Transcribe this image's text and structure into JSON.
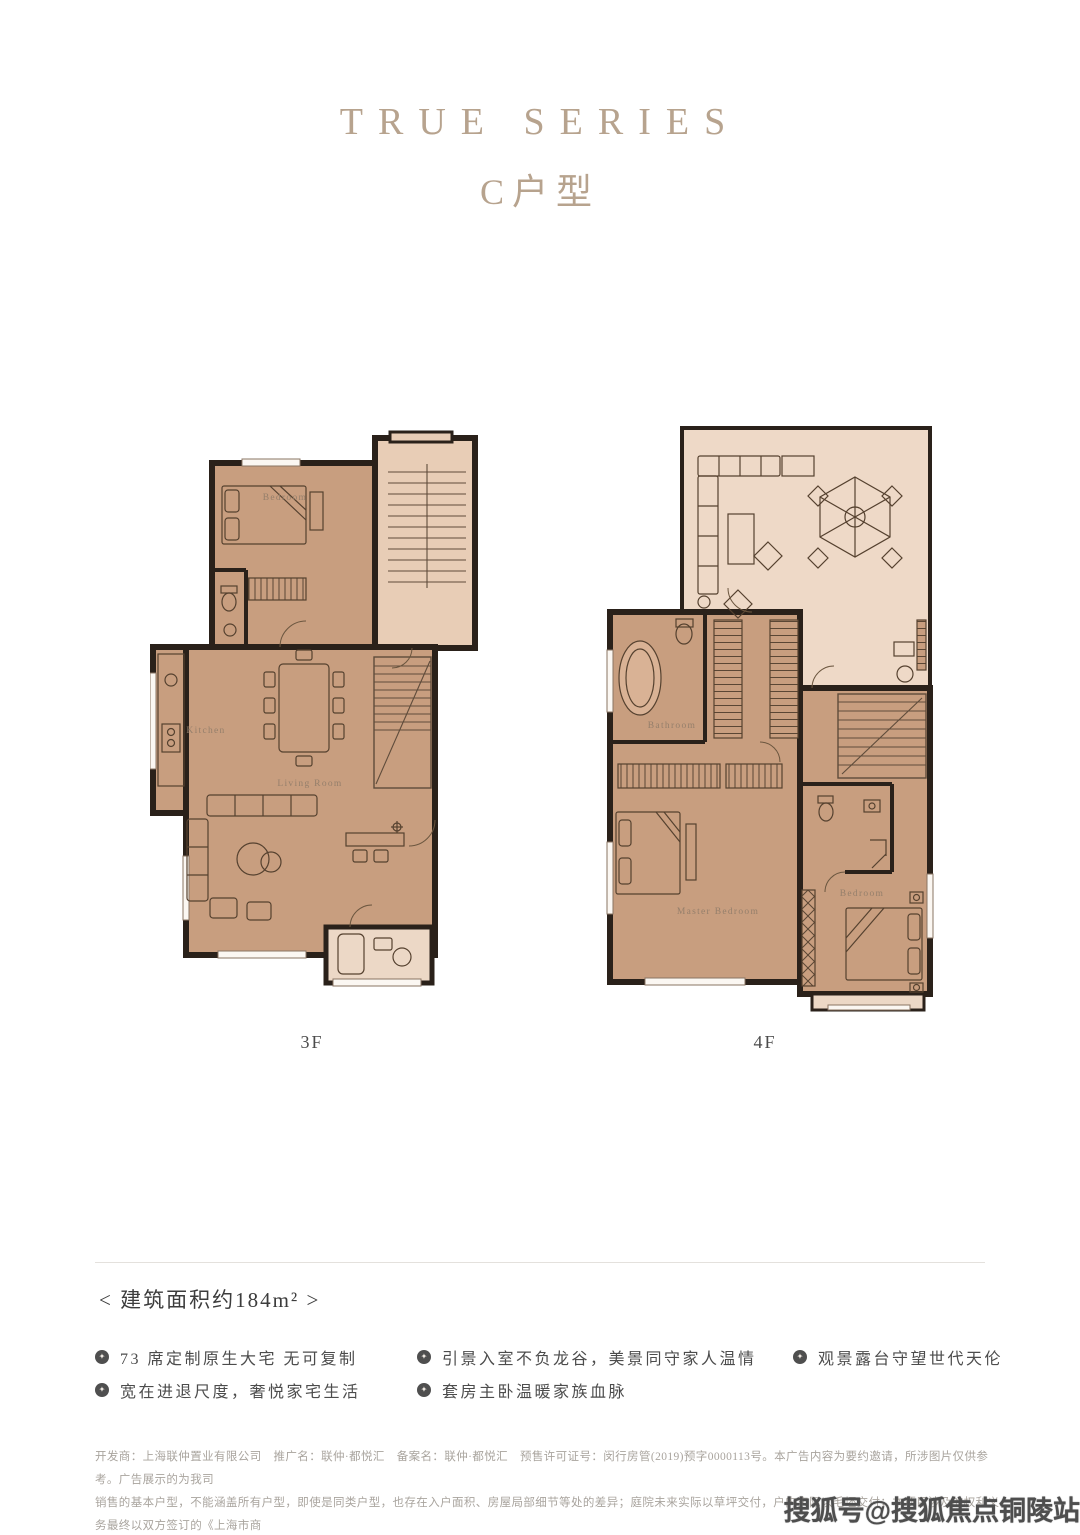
{
  "page": {
    "width": 1080,
    "height": 1535,
    "background": "#ffffff"
  },
  "header": {
    "series_title": "TRUE SERIES",
    "unit_title": "C户型",
    "accent_color": "#b7a38e"
  },
  "floorplans": {
    "colors": {
      "wall": "#2a211a",
      "room_fill": "#c89e7f",
      "stair_fill": "#e8cdb6",
      "terrace_fill": "#eed9c7",
      "balcony_fill": "#ecd8c6",
      "furniture_line": "#55412f",
      "label_text": "#957f6b"
    },
    "left": {
      "floor_label": "3F",
      "room_labels": {
        "bedroom": "Bedroom",
        "kitchen": "Kitchen",
        "living_room": "Living Room"
      }
    },
    "right": {
      "floor_label": "4F",
      "room_labels": {
        "bathroom": "Bathroom",
        "master_bedroom": "Master Bedroom",
        "bedroom": "Bedroom"
      }
    }
  },
  "area": {
    "text": "<  建筑面积约184m²  >"
  },
  "features": {
    "bullet_glyph": "✦",
    "col1": [
      "73 席定制原生大宅 无可复制",
      "宽在进退尺度，奢悦家宅生活"
    ],
    "col2": [
      "引景入室不负龙谷，美景同守家人温情",
      "套房主卧温暖家族血脉"
    ],
    "col3": [
      "观景露台守望世代天伦"
    ]
  },
  "disclaimer": {
    "lines": [
      "开发商：上海联仲置业有限公司　推广名：联仲·都悦汇　备案名：联仲·都悦汇　预售许可证号：闵行房管(2019)预字0000113号。本广告内容为要约邀请，所涉图片仅供参考。广告展示的为我司",
      "销售的基本户型，不能涵盖所有户型，即使是同类户型，也存在入户面积、房屋局部细节等处的差异；庭院未来实际以草坪交付，户内实际以毛坯交付；本项目涉及的权利义务最终以双方签订的《上海市商",
      "品房预售合同》为准。印刷时间 2019 年 6 月"
    ]
  },
  "watermark": {
    "text": "搜狐号@搜狐焦点铜陵站"
  }
}
